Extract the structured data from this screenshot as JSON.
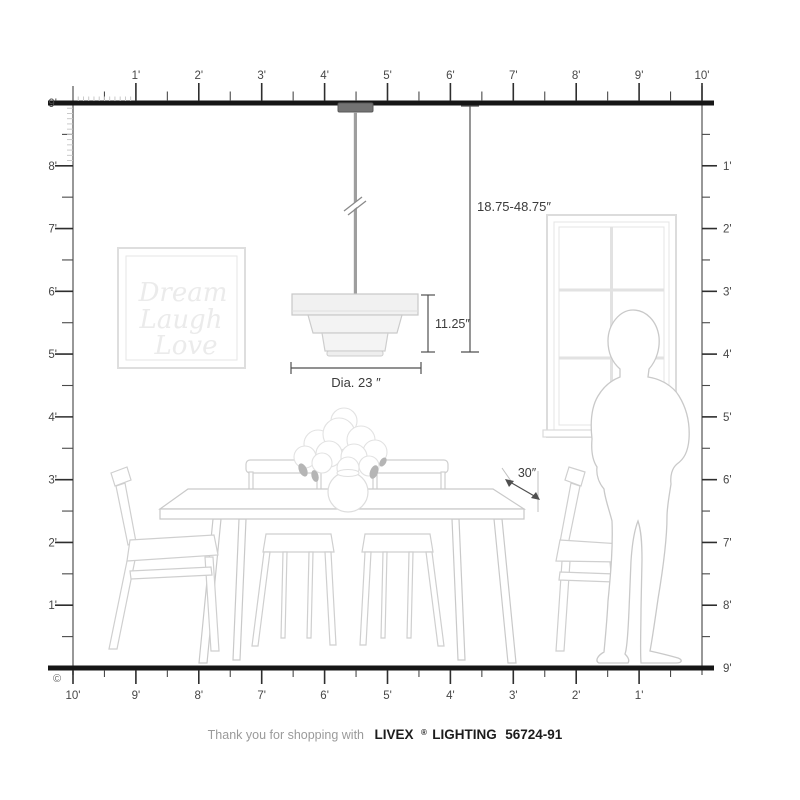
{
  "annotations": {
    "hanging_height": "18.75-48.75″",
    "fixture_height": "11.25″",
    "diameter": "Dia. 23 ″",
    "table_depth": "30″"
  },
  "wall_art": {
    "line1": "Dream",
    "line2": "Laugh",
    "line3": "Love"
  },
  "rulers": {
    "copyright_symbol": "©",
    "top": {
      "labels": [
        "1'",
        "2'",
        "3'",
        "4'",
        "5'",
        "6'",
        "7'",
        "8'",
        "9'",
        "10'"
      ]
    },
    "left": {
      "labels": [
        "9'",
        "8'",
        "7'",
        "6'",
        "5'",
        "4'",
        "3'",
        "2'",
        "1'"
      ]
    },
    "right": {
      "labels": [
        "1'",
        "2'",
        "3'",
        "4'",
        "5'",
        "6'",
        "7'",
        "8'",
        "9'"
      ]
    },
    "bottom": {
      "labels": [
        "10'",
        "9'",
        "8'",
        "7'",
        "6'",
        "5'",
        "4'",
        "3'",
        "2'",
        "1'"
      ]
    }
  },
  "footer": {
    "prefix": "Thank you for shopping with",
    "brand": "LIVEX",
    "registered_mark": "®",
    "product_line": "LIGHTING",
    "model_number": "56724-91"
  },
  "colors": {
    "ruler_heavy_line": "#161616",
    "ruler_tick": "#2e2e2e",
    "dimension_line": "#4f4f4f",
    "furniture_line": "#cfcfcf",
    "canopy": "#737373",
    "rod": "#9e9e9e",
    "shade_fill": "#f2f2f2"
  }
}
